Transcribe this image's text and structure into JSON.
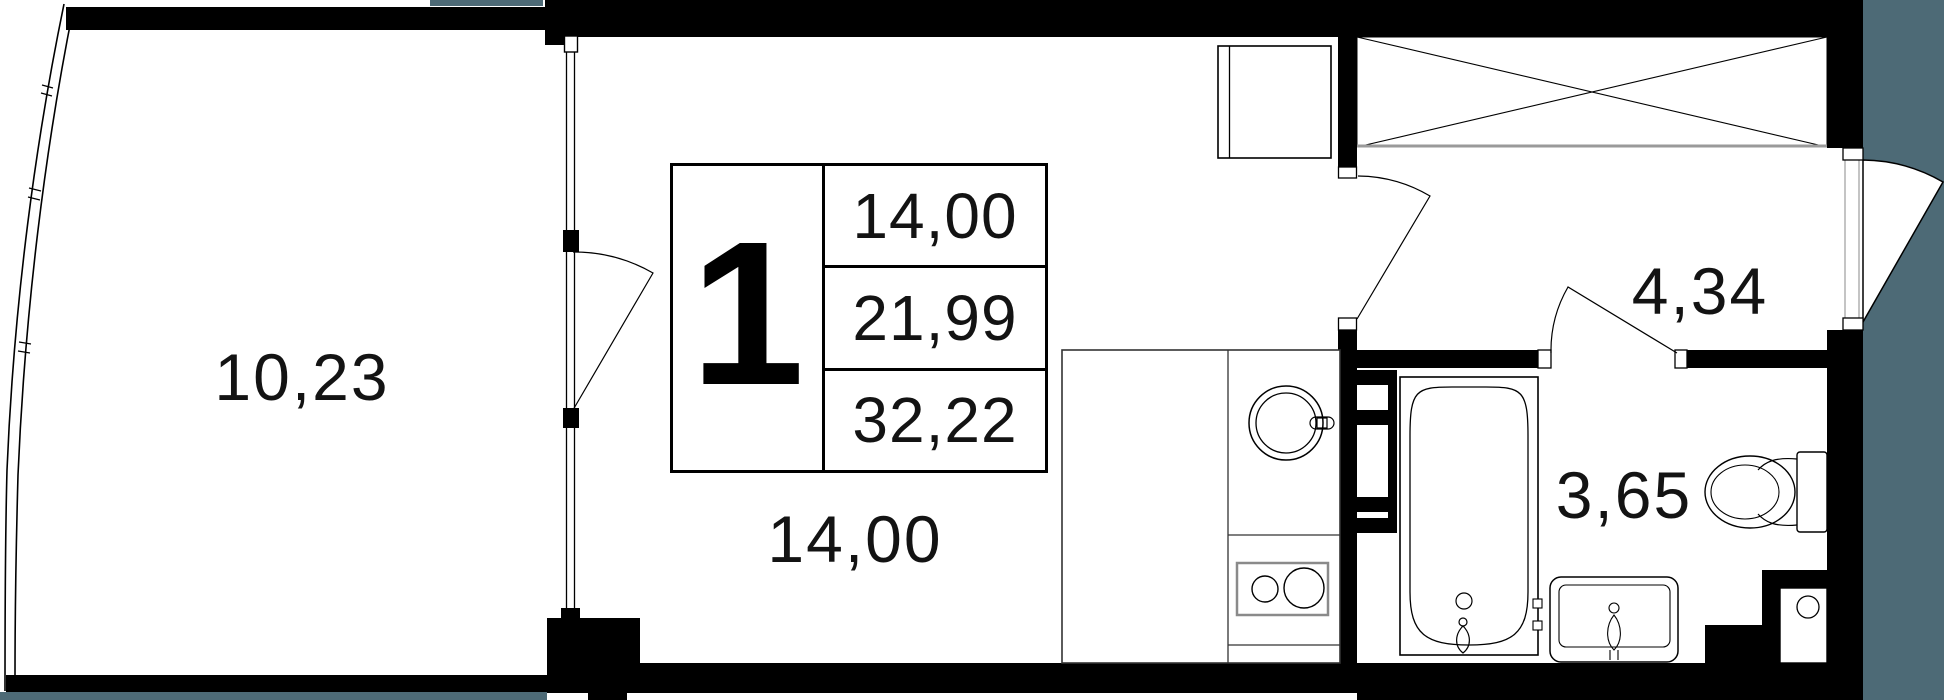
{
  "floor_plan": {
    "unit_stamp": {
      "number": "1",
      "living_area": "14,00",
      "apartment_area": "21,99",
      "total_area": "32,22"
    },
    "room_labels": {
      "balcony": "10,23",
      "living_room": "14,00",
      "hallway": "4,34",
      "bathroom": "3,65"
    },
    "colors": {
      "wall": "#000000",
      "adjacent_area": "#4d6a76",
      "wardrobe_front": "#9a9a9a"
    },
    "fixtures": [
      "refrigerator",
      "wardrobe",
      "kitchen-counter",
      "kitchen-sink",
      "cooktop",
      "towel-rail",
      "bathtub",
      "washbasin",
      "toilet",
      "vent-shaft"
    ]
  }
}
